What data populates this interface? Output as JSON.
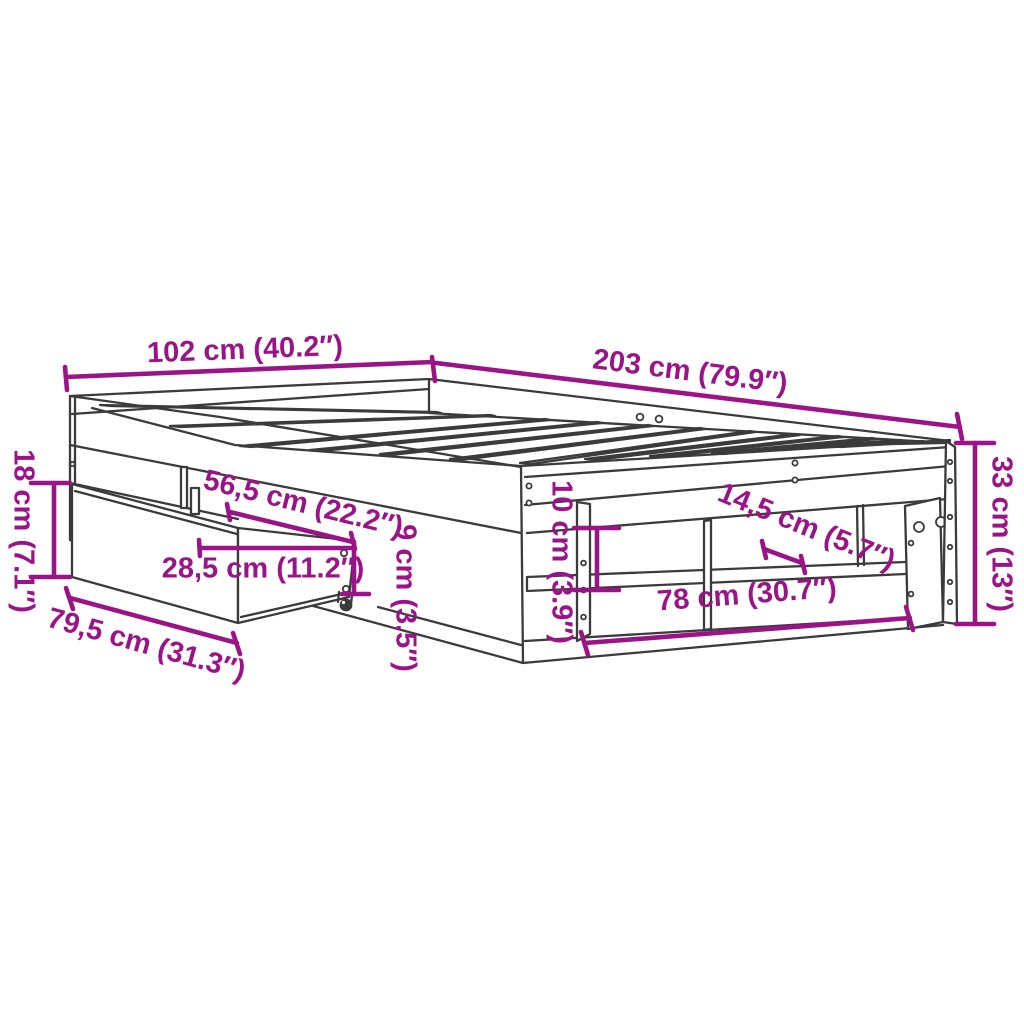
{
  "diagram": {
    "background_color": "#ffffff",
    "dimension_color": "#9A1488",
    "drawing_color": "#3B3B3B",
    "measurements": [
      {
        "id": "total-width",
        "label": "102 cm (40.2″)",
        "text": {
          "x": 245,
          "y": 351,
          "rot": -2.2
        },
        "lines": [
          [
            66,
            377,
            433,
            362
          ],
          [
            65,
            367,
            67,
            390
          ],
          [
            432,
            357,
            435,
            381
          ]
        ]
      },
      {
        "id": "total-length",
        "label": "203 cm (79.9″)",
        "text": {
          "x": 690,
          "y": 373,
          "rot": 7.3
        },
        "lines": [
          [
            436,
            363,
            960,
            427
          ],
          [
            957,
            414,
            962,
            439
          ]
        ]
      },
      {
        "id": "drawer-front-height",
        "label": "18 cm (7.1″)",
        "text": {
          "x": 22,
          "y": 531,
          "rot": 90
        },
        "lines": [
          [
            54,
            483,
            54,
            577
          ],
          [
            31,
            483,
            70,
            483
          ],
          [
            31,
            577,
            70,
            577
          ]
        ]
      },
      {
        "id": "drawer-length",
        "label": "79,5 cm (31.3″)",
        "text": {
          "x": 146,
          "y": 646,
          "rot": 15.5
        },
        "lines": [
          [
            70,
            598,
            237,
            643
          ],
          [
            66,
            588,
            73,
            609
          ],
          [
            233,
            633,
            240,
            654
          ]
        ]
      },
      {
        "id": "drawer-extension",
        "label": "56,5 cm (22.2″)",
        "text": {
          "x": 303,
          "y": 505,
          "rot": 13.7
        },
        "lines": [
          [
            230,
            512,
            353,
            542
          ],
          [
            227,
            504,
            230,
            520
          ],
          [
            351,
            533,
            355,
            549
          ]
        ]
      },
      {
        "id": "drawer-inner-width",
        "label": "28,5 cm (11.2″)",
        "text": {
          "x": 263,
          "y": 570,
          "rot": 0
        },
        "lines": [
          [
            200,
            548,
            352,
            548
          ],
          [
            199,
            540,
            200,
            556
          ]
        ]
      },
      {
        "id": "drawer-height",
        "label": "9 cm (3.5″)",
        "text": {
          "x": 404,
          "y": 598,
          "rot": 90
        },
        "lines": [
          [
            354,
            542,
            354,
            594
          ],
          [
            342,
            594,
            369,
            594
          ]
        ]
      },
      {
        "id": "shelf-clearance",
        "label": "10 cm (3.9″)",
        "text": {
          "x": 560,
          "y": 562,
          "rot": 90
        },
        "lines": [
          [
            597,
            528,
            597,
            590
          ],
          [
            574,
            528,
            619,
            528
          ],
          [
            574,
            590,
            619,
            590
          ]
        ]
      },
      {
        "id": "shelf-depth",
        "label": "14,5 cm (5.7″)",
        "text": {
          "x": 806,
          "y": 528,
          "rot": 22
        },
        "lines": [
          [
            764,
            549,
            802,
            563
          ],
          [
            762,
            541,
            766,
            558
          ],
          [
            801,
            556,
            805,
            573
          ]
        ]
      },
      {
        "id": "shelf-width",
        "label": "78 cm (30.7″)",
        "text": {
          "x": 747,
          "y": 596,
          "rot": -4.4
        },
        "lines": [
          [
            585,
            643,
            910,
            618
          ],
          [
            581,
            632,
            588,
            655
          ],
          [
            906,
            607,
            913,
            630
          ]
        ]
      },
      {
        "id": "frame-height",
        "label": "33 cm (13″)",
        "text": {
          "x": 1000,
          "y": 534,
          "rot": 90
        },
        "lines": [
          [
            975,
            443,
            975,
            624
          ],
          [
            956,
            443,
            994,
            443
          ],
          [
            956,
            624,
            994,
            624
          ]
        ]
      }
    ]
  }
}
